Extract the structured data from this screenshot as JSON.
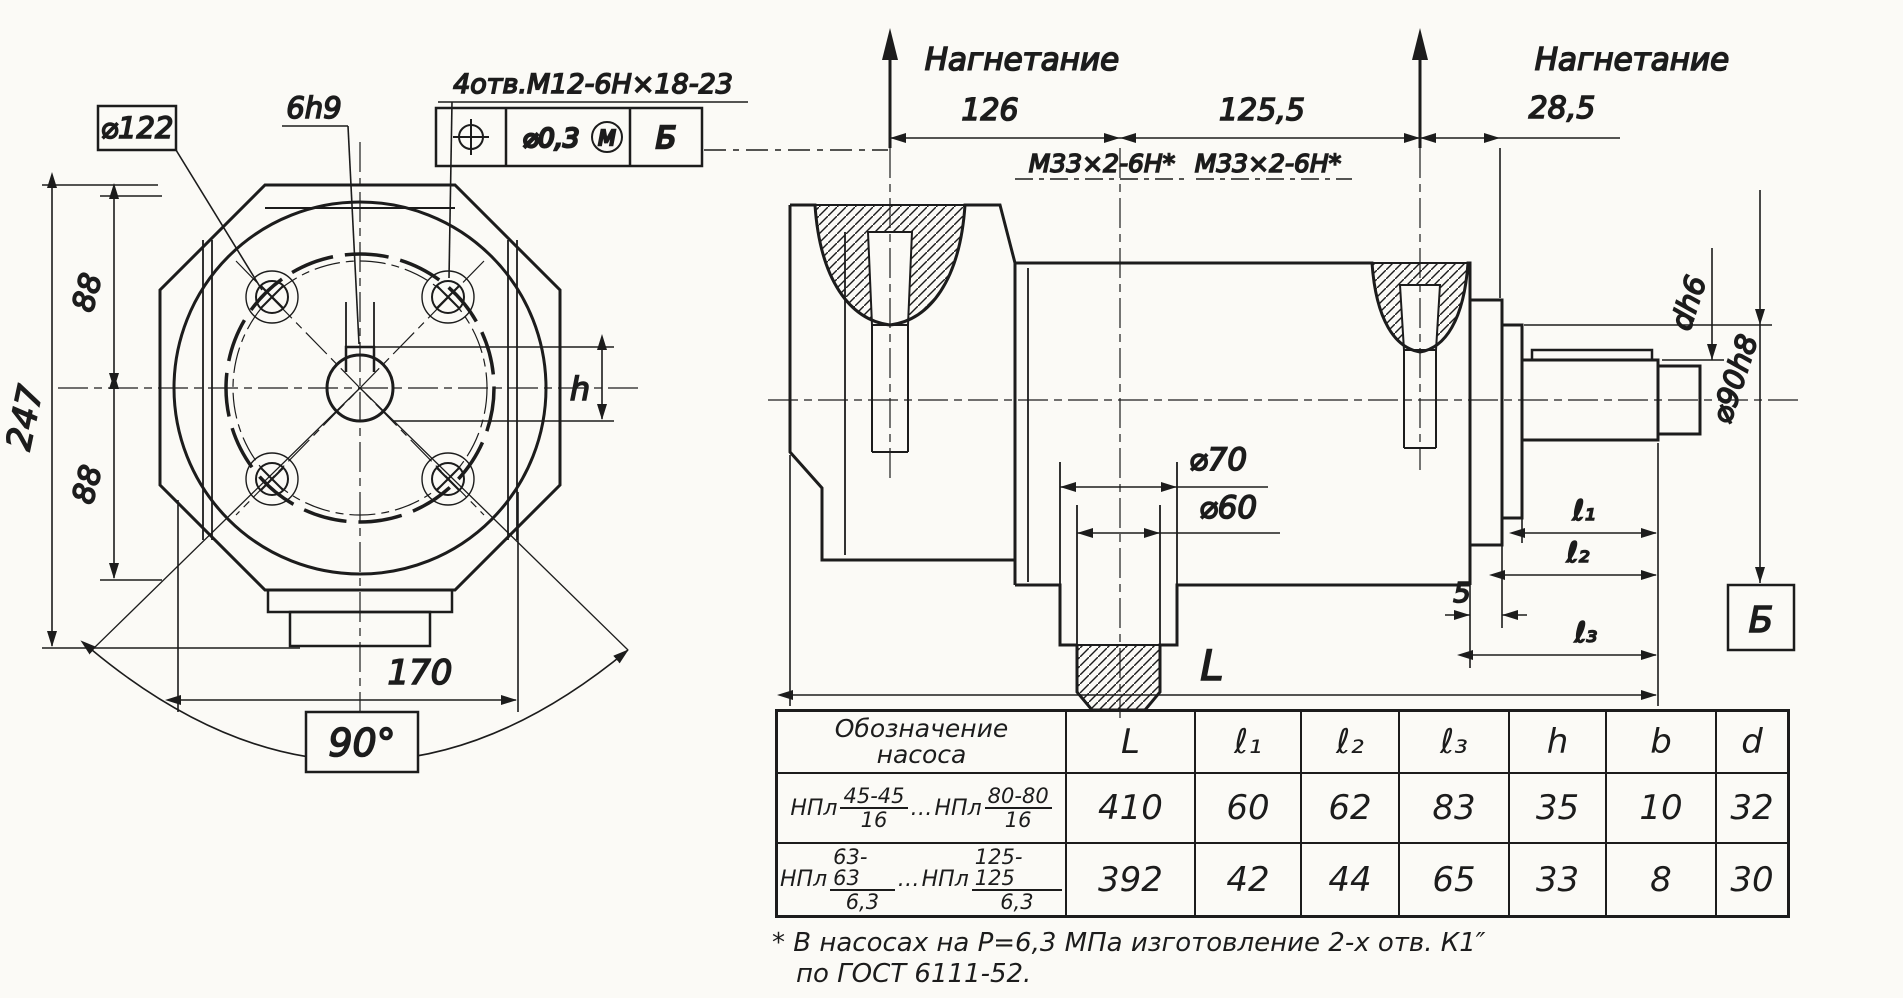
{
  "front_view": {
    "dia122": "⌀122",
    "key_label": "6h9",
    "holes_note": "4отв.М12-6Н×18-23",
    "fcf": {
      "tolerance": "⌀0,3",
      "modifier": "М",
      "datum": "Б"
    },
    "dim_247": "247",
    "dim_88_top": "88",
    "dim_88_bottom": "88",
    "dim_h": "h",
    "dim_170": "170",
    "angle_90": "90°"
  },
  "side_view": {
    "discharge_left": "Нагнетание",
    "discharge_right": "Нагнетание",
    "dim_126": "126",
    "dim_125_5": "125,5",
    "dim_28_5": "28,5",
    "thread_left": "М33×2-6Н*",
    "thread_right": "М33×2-6Н*",
    "dia_70": "⌀70",
    "dia_60": "⌀60",
    "shaft_dia": "dh6",
    "dia_90h8": "⌀90h8",
    "dim_l1": "ℓ₁",
    "dim_l2": "ℓ₂",
    "dim_5": "5",
    "dim_l3": "ℓ₃",
    "dim_L": "L",
    "datum_b": "Б"
  },
  "table": {
    "header": {
      "designation_line1": "Обозначение",
      "designation_line2": "насоса",
      "L": "L",
      "l1": "ℓ₁",
      "l2": "ℓ₂",
      "l3": "ℓ₃",
      "h": "h",
      "b": "b",
      "d": "d"
    },
    "rows": [
      {
        "prefix1": "НПл",
        "num1": "45-45",
        "den1": "16",
        "dots": "…",
        "prefix2": "НПл",
        "num2": "80-80",
        "den2": "16",
        "L": "410",
        "l1": "60",
        "l2": "62",
        "l3": "83",
        "h": "35",
        "b": "10",
        "d": "32"
      },
      {
        "prefix1": "НПл",
        "num1": "63-63",
        "den1": "6,3",
        "dots": "…",
        "prefix2": "НПл",
        "num2": "125-125",
        "den2": "6,3",
        "L": "392",
        "l1": "42",
        "l2": "44",
        "l3": "65",
        "h": "33",
        "b": "8",
        "d": "30"
      }
    ]
  },
  "footnote": {
    "line1": "* В насосах на Р=6,3 МПа изготовление 2-х отв. К1″",
    "line2": "по ГОСТ 6111-52."
  }
}
